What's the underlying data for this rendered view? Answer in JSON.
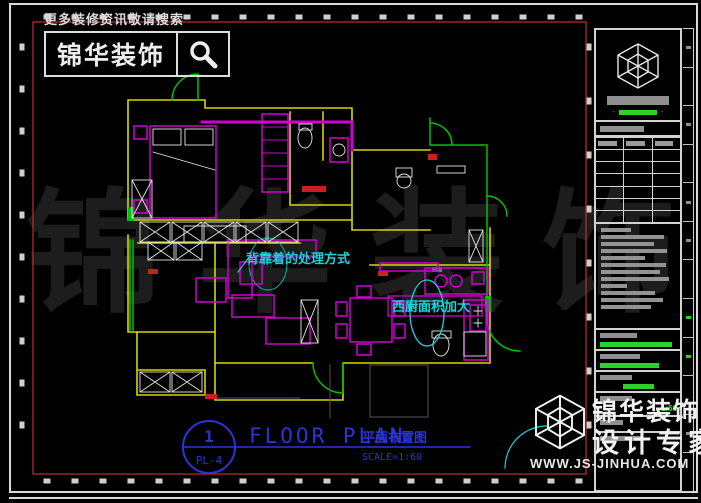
{
  "colors": {
    "wall_yellow": "#d6d600",
    "furniture_magenta": "#cf00cf",
    "door_green": "#00c000",
    "annotation_cyan": "#19d2e0",
    "title_blue": "#2a35d8",
    "frame_red": "#b22a2a",
    "line_white": "#e6e6e6"
  },
  "header": {
    "search_hint": "更多装修资讯敬请搜索",
    "brand": "锦华装饰"
  },
  "watermark": {
    "chars": [
      "锦",
      "华",
      "装",
      "饰"
    ]
  },
  "plan": {
    "annotation_backrest": "背靠着的处理方式",
    "annotation_kitchen": "西厨面积加大"
  },
  "titlebar": {
    "number": "1",
    "sheet_code": "PL-4",
    "title": "FLOOR PLAN",
    "subtitle_cn": "平面布置图",
    "scale": "SCALE=1:60"
  },
  "titleblock": {
    "table": {
      "cols": 3,
      "rows": 7
    },
    "notes_bars": [
      40,
      84,
      70,
      88,
      58,
      86,
      78,
      90,
      34,
      72,
      82,
      66
    ],
    "info_rows": [
      {
        "label_w": 48,
        "green_w": 94
      },
      {
        "label_w": 52,
        "green_w": 76
      },
      {
        "label_w": 42,
        "green_w": 40,
        "align": "center"
      },
      {
        "label_w": 42,
        "green_text": "1:60"
      },
      {
        "label_w": 30
      },
      {
        "label_w": 56
      }
    ],
    "edge_cells": [
      "gray",
      "none",
      "gray",
      "none",
      "gray",
      "gray",
      "none",
      "green",
      "green",
      "none",
      "gray",
      "none"
    ]
  },
  "footer_brand": {
    "brand": "锦华装饰",
    "tagline": "设计专家",
    "website": "WWW.JS-JINHUA.COM"
  }
}
